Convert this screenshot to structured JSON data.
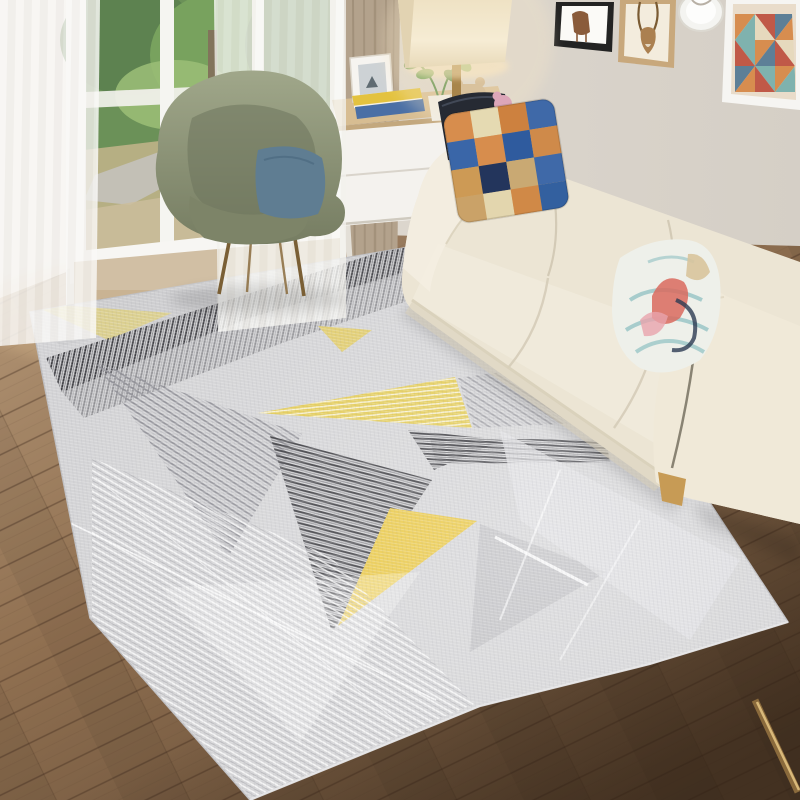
{
  "meta": {
    "domain": "natural-image",
    "subject": "geometric-area-rug-product-photo",
    "setting": "scandinavian-living-room",
    "visible_text": ""
  },
  "palette": {
    "wall": "#d9d3ca",
    "wallLight": "#ebe7e0",
    "wallShade": "#cfc8be",
    "floorLight": "#b59878",
    "floorMid": "#8a6b4e",
    "floorDark": "#5c4632",
    "plankLine": "#3a2617",
    "windowFrame": "#f4f3ef",
    "foliageDark": "#3f6b2f",
    "foliage": "#5f9140",
    "foliageLight": "#86b05c",
    "path": "#b8b4a8",
    "grass": "#a8a06c",
    "balcony": "#c9b393",
    "railing": "#f0efe9",
    "sheer": "#f7f6f3",
    "curtainTan": "#b3a28c",
    "curtainTanDark": "#94836c",
    "frameBlack": "#232323",
    "frameWood": "#c8a87c",
    "frameWhite": "#f6f5f2",
    "artBg": "#e9dcca",
    "artOrange": "#d78d4f",
    "artTeal": "#7fb2ae",
    "artRed": "#c05948",
    "artSlate": "#5d7f97",
    "artCream": "#e6d9bd",
    "antelope": "#ab8050",
    "artFigure": "#8a5b3a",
    "plate": "#f4f4f1",
    "lampShade": "#f4e9cf",
    "lampGlow": "#ffe9bf",
    "brass": "#a8854b",
    "brassLight": "#d9b97a",
    "tableWood": "#d7bd92",
    "tableWhite": "#f4f2ee",
    "tableShadow": "#d9d4cb",
    "bookYellow": "#e3c23f",
    "bookBlue": "#4a6fa5",
    "potWhite": "#f0eee8",
    "plant": "#5d8f4a",
    "plantLight": "#7fae63",
    "bear": "#cdb28b",
    "photoFrame": "#f6f4f0",
    "photoImg": "#cdd2d5",
    "chair": "#99a083",
    "chairDark": "#7d8468",
    "chairShade": "#6e755c",
    "chairPillow": "#5f7d92",
    "chairLeg": "#7a5f35",
    "sofa": "#ece5d4",
    "sofaLight": "#f4efe2",
    "sofaShade": "#d8cfb9",
    "sofaDeep": "#c2b89f",
    "sofaPiping": "#7d7868",
    "legWood": "#c79b55",
    "pillowNavy": "#262a33",
    "pillowPink": "#dca6b8",
    "pBlue": "#3f69a8",
    "pOrange": "#d78d4d",
    "pTan": "#c9a973",
    "pCream": "#e5dab2",
    "pNavy": "#23355c",
    "pBase": "#d3a86e",
    "floralBase": "#eef0ea",
    "floralTeal": "#8fc0c2",
    "floralRed": "#d96a5e",
    "floralPink": "#e8a4ac",
    "floralTan": "#d8c49c",
    "floralNavy": "#2c3b52",
    "rugBase": "#d3d3d5",
    "rugLight": "#e1e1e3",
    "rugGray": "#9a9aa0",
    "rugMid": "#bcbcc0",
    "rugDark": "#3a3a3f",
    "rugStripeDark": "#47474c",
    "rugYellow": "#e9c63e",
    "rugYellowSoft": "#e2c94e",
    "rugPale": "#dbcf8e",
    "rugPale2": "#e0cb6a",
    "rugWhite": "#ffffff",
    "rugEdge": "#bfbfc2",
    "rugTopShade": "#c9c9cc",
    "pole": "#8a6a3c",
    "shadow": "#000000"
  },
  "scene": {
    "objects": [
      {
        "name": "window",
        "detail": "white frame, sheer curtains, garden view"
      },
      {
        "name": "tan-curtain",
        "detail": "solid khaki drape beside window"
      },
      {
        "name": "womb-chair",
        "detail": "sage green with slate blue pillow, metal legs"
      },
      {
        "name": "side-table",
        "detail": "white drawers, wood top, books, plant, photo frame, figurine"
      },
      {
        "name": "table-lamp",
        "detail": "cream rectangular shade, lit, brass stem"
      },
      {
        "name": "wall-art",
        "detail": "black frame print, antelope print in wood frame, round plate, triangle-sweater portrait"
      },
      {
        "name": "sofa",
        "detail": "cream three-seat with checkered, navy and floral pillows, wood leg"
      },
      {
        "name": "wood-floor",
        "detail": "brown diagonal planks"
      },
      {
        "name": "area-rug",
        "detail": "light gray with gray/charcoal striped, yellow and white triangles"
      }
    ]
  }
}
